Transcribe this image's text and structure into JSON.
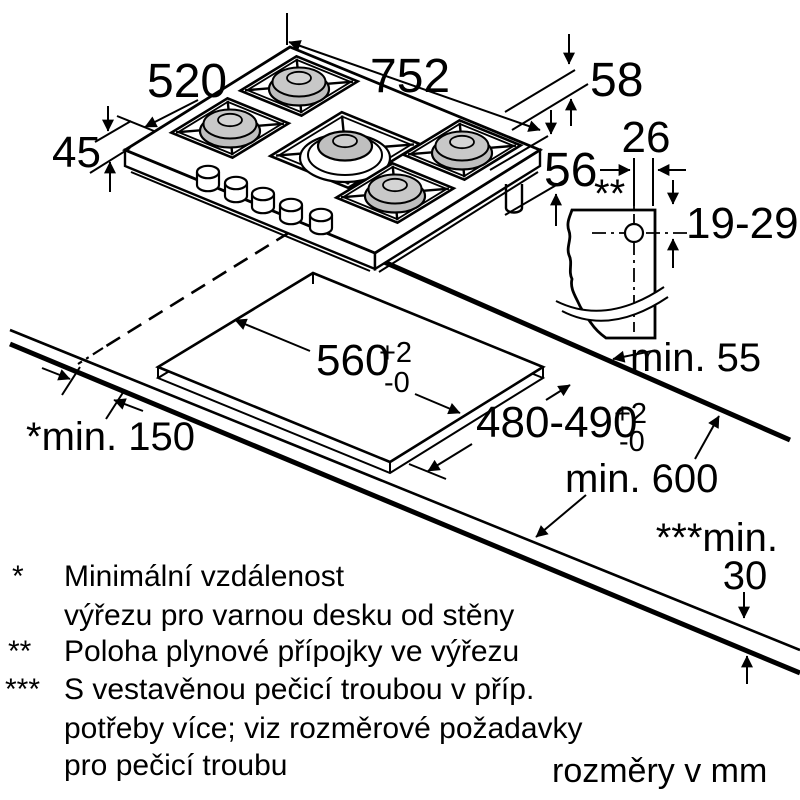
{
  "diagram": {
    "title_hint": "gas hob installation dimensions",
    "units_note": "rozměry v mm",
    "colors": {
      "line": "#000000",
      "burner_cap": "#bfbfbf",
      "background": "#ffffff"
    },
    "dims": {
      "hob_width": "752",
      "hob_depth": "520",
      "hob_height": "45",
      "gas_offset_1": "58",
      "gas_offset_2": "56",
      "detail_offset": "26",
      "detail_range": "19-29",
      "detail_marker": "**",
      "min_back": "min. 55",
      "cutout_width": "560",
      "cutout_width_tol_plus": "+2",
      "cutout_width_tol_minus": "-0",
      "cutout_depth": "480-490",
      "cutout_depth_tol_plus": "+2",
      "cutout_depth_tol_minus": "-0",
      "min_side_wall": "*min. 150",
      "min_worktop_depth": "min. 600",
      "min_below_prefix": "***min.",
      "min_below_value": "30"
    },
    "footnotes": [
      {
        "marker": "*",
        "lines": [
          "Minimální vzdálenost",
          "výřezu pro varnou desku od stěny"
        ]
      },
      {
        "marker": "**",
        "lines": [
          "Poloha plynové přípojky ve výřezu"
        ]
      },
      {
        "marker": "***",
        "lines": [
          "S vestavěnou pečicí troubou v příp.",
          "potřeby více; viz rozměrové požadavky",
          "pro pečicí troubu"
        ]
      }
    ]
  }
}
